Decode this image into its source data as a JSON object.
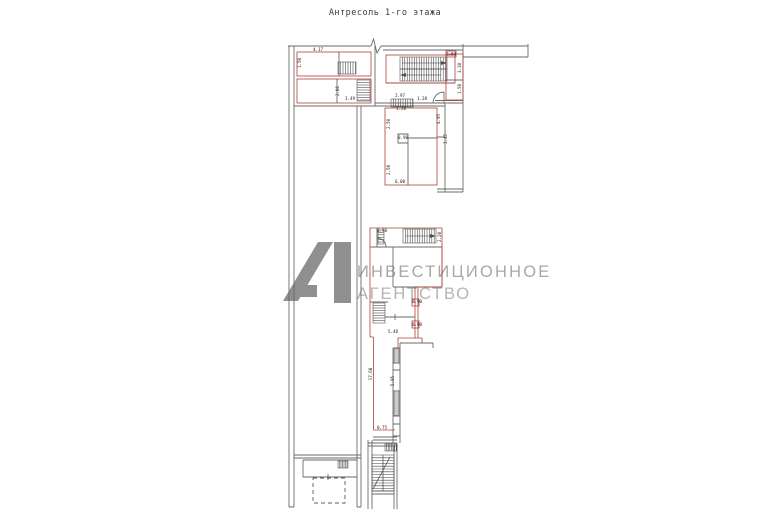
{
  "title": "Антресоль 1-го этажа",
  "watermark": {
    "line1": "ИНВЕСТИЦИОННОЕ",
    "line2": "АГЕНТСТВО",
    "logo_color": "#8f8f8f",
    "line1_color": "#a8a8a8",
    "line2_color": "#b4b4b4"
  },
  "colors": {
    "wall_gray": "#6a6a6a",
    "room_outline_red": "#b04038",
    "hatch": "#3f3f3f"
  },
  "dimension_labels": [
    {
      "text": "4.17",
      "x": 318,
      "y": 51,
      "rot": 0
    },
    {
      "text": "1.50",
      "x": 301,
      "y": 63,
      "rot": -90
    },
    {
      "text": "2.86",
      "x": 339,
      "y": 91,
      "rot": -90
    },
    {
      "text": "3.49",
      "x": 350,
      "y": 100,
      "rot": 0
    },
    {
      "text": "2.97",
      "x": 400,
      "y": 97,
      "rot": 0
    },
    {
      "text": "1.28",
      "x": 422,
      "y": 100,
      "rot": 0
    },
    {
      "text": "1.20",
      "x": 401,
      "y": 110,
      "rot": 0
    },
    {
      "text": "2.84",
      "x": 451,
      "y": 55.5,
      "rot": 0
    },
    {
      "text": "3.10",
      "x": 461,
      "y": 68,
      "rot": -90
    },
    {
      "text": "1.50",
      "x": 461,
      "y": 89,
      "rot": -90
    },
    {
      "text": "2.50",
      "x": 390,
      "y": 124,
      "rot": -90
    },
    {
      "text": "4.95",
      "x": 440,
      "y": 119,
      "rot": -90
    },
    {
      "text": "0.90",
      "x": 403,
      "y": 139,
      "rot": 0
    },
    {
      "text": "2.50",
      "x": 390,
      "y": 170,
      "rot": -90
    },
    {
      "text": "6.00",
      "x": 400,
      "y": 183,
      "rot": 0
    },
    {
      "text": "1.45",
      "x": 447,
      "y": 139,
      "rot": -90
    },
    {
      "text": "0.90",
      "x": 382,
      "y": 232,
      "rot": 0
    },
    {
      "text": "2.20",
      "x": 441,
      "y": 237,
      "rot": -90
    },
    {
      "text": "0.90",
      "x": 417,
      "y": 303,
      "rot": 0
    },
    {
      "text": "0.90",
      "x": 417,
      "y": 326,
      "rot": 0
    },
    {
      "text": "5.48",
      "x": 393,
      "y": 333,
      "rot": 0
    },
    {
      "text": "17.68",
      "x": 372,
      "y": 374,
      "rot": -90
    },
    {
      "text": "5.95",
      "x": 394,
      "y": 381,
      "rot": -90
    },
    {
      "text": "0.75",
      "x": 382,
      "y": 429,
      "rot": 0
    }
  ]
}
